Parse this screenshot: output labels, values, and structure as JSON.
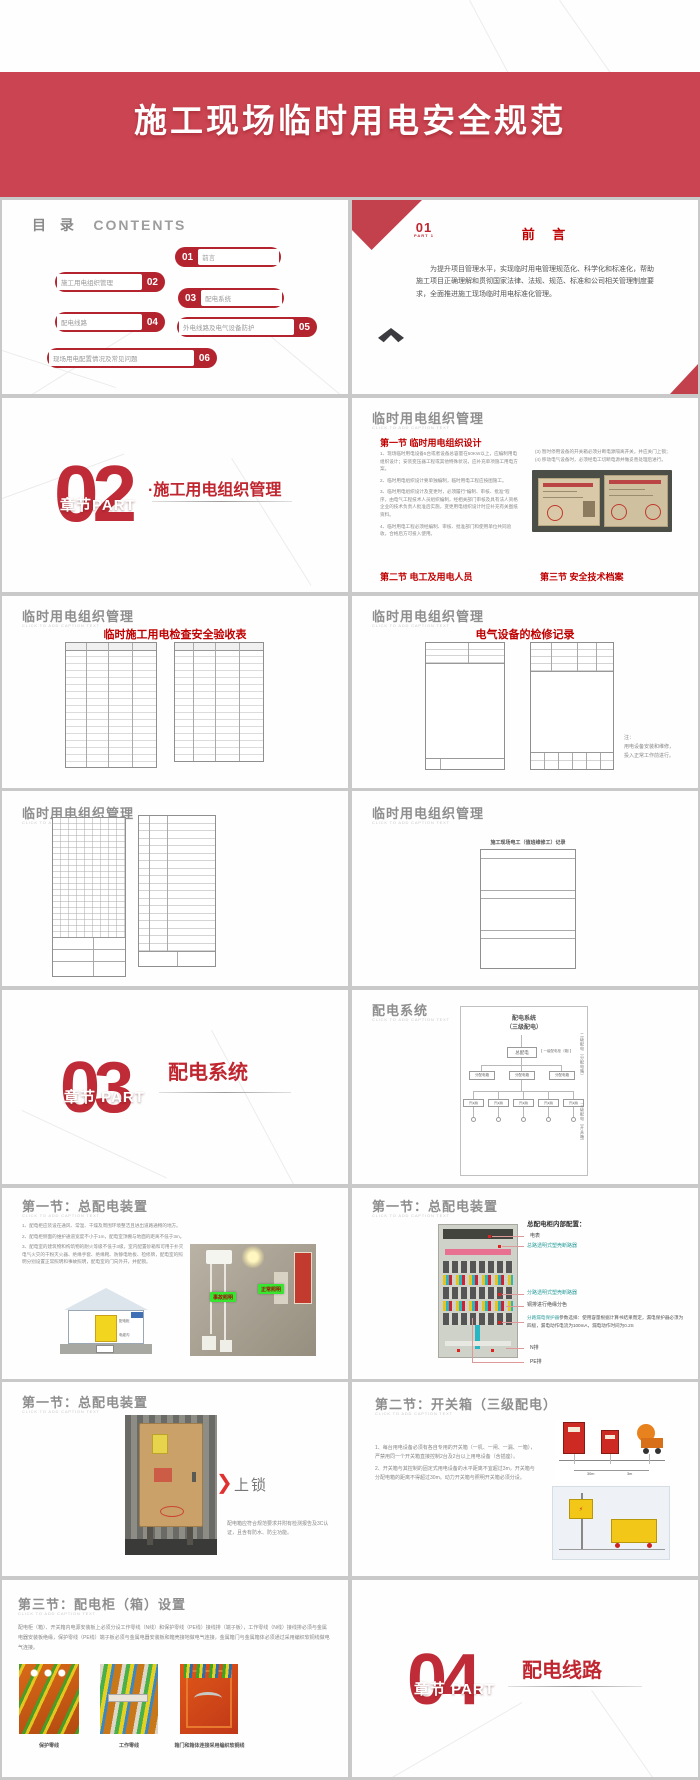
{
  "colors": {
    "banner_red": "#cb4451",
    "pill_red": "#b3242e",
    "number_red": "#bf2b36",
    "heading_red": "#c00000",
    "teal": "#2e9e9e",
    "callout_green": "#35e52f"
  },
  "cover": {
    "title": "施工现场临时用电安全规范"
  },
  "contents": {
    "heading_cn": "目 录",
    "heading_en": "CONTENTS",
    "items": [
      {
        "num": "01",
        "label": "前言"
      },
      {
        "num": "02",
        "label": "施工用电组织管理"
      },
      {
        "num": "03",
        "label": "配电系统"
      },
      {
        "num": "04",
        "label": "配电线路"
      },
      {
        "num": "05",
        "label": "外电线路及电气设备防护"
      },
      {
        "num": "06",
        "label": "现场用电配置情况及常见问题"
      }
    ]
  },
  "preface": {
    "part_num": "01",
    "part_label": "PART 1",
    "title": "前 言",
    "body": "为提升项目管理水平，实现临时用电管理规范化、科学化和标准化，帮助施工项目正确理解和贯彻国家法律、法规、规范、标准和公司相关管理制度要求，全面推进施工现场临时用电标准化管理。"
  },
  "section02": {
    "number": "02",
    "chapter": "章节PART",
    "title": "·施工用电组织管理"
  },
  "org_mgmt": {
    "title": "临时用电组织管理",
    "caption": "CLICK TO ADD CAPTION TEXT",
    "sec1": "第一节 临时用电组织设计",
    "para1": "1、现场临时用电设备5台或者设备总容量在50KW以上，应编制用电组织设计；安装变压器工程或其他特殊状况，应补充单项施工用电方案。",
    "para2": "2、临时用电组织设计要单独编制，临时用电工程应按图施工。",
    "para3": "3、临时用电组织设计及变更时，必须履行“编制、审核、批准”程序，由电气工程技术人员组织编制，经相关部门审核及具有法人资格企业的技术负责人批准后实施，变更用电组织设计时应补充有关图纸资料。",
    "para4": "4、临时用电工程必须经编制、审核、批准部门和使用单位共同验收，合格后方可投入使用。",
    "right_item3": "(3) 暂时停用设备的开关箱必须分断电源隔离开关，并应关门上锁；",
    "right_item4": "(4) 移动电气设备时，必须经电工切断电源并做妥善处理后进行。",
    "sec2": "第二节 电工及用电人员",
    "sec3": "第三节 安全技术档案"
  },
  "checklist": {
    "title": "临时用电组织管理",
    "caption": "CLICK TO ADD CAPTION TEXT",
    "heading": "临时施工用电检查安全验收表"
  },
  "repair": {
    "title": "临时用电组织管理",
    "caption": "CLICK TO ADD CAPTION TEXT",
    "heading": "电气设备的检修记录",
    "note": "注：\n用电设备安装和维修，\n投入正常工作前进行。"
  },
  "records": {
    "title": "临时用电组织管理",
    "caption": "CLICK TO ADD CAPTION TEXT"
  },
  "electrician": {
    "title": "临时用电组织管理",
    "caption": "CLICK TO ADD CAPTION TEXT",
    "form_title": "施工现场电工（值班维修工）记录"
  },
  "section03": {
    "number": "03",
    "chapter": "章节 PART",
    "title": "配电系统"
  },
  "dist_system": {
    "title": "配电系统",
    "caption": "CLICK TO ADD CAPTION TEXT",
    "diagram_title": "配电系统\n（三级配电）",
    "root": "总配电",
    "level1": "【 一级配电柜（箱）】",
    "level2": "二级配电（分配电箱）",
    "level3": "三级配电（开关箱）",
    "box2": "分配电箱",
    "box3": "开关箱"
  },
  "main_dist1": {
    "title": "第一节：总配电装置",
    "caption": "CLICK TO ADD CAPTION TEXT",
    "para1": "1、配电柜应装设在通风、常温、干燥及周围环境整洁且进出道路通畅的地方。",
    "para2": "2、配电柜侧面的维护通道宽度不小于1m，配电室顶棚与地面的距离不低于3m。",
    "para3": "3、配电室的建筑物和构筑物的耐火等级不低于3级，室内配置砂箱和可用于扑灭电气火灾的干粉灭火器、绝缘手套、绝缘靴、防静电地板、检修牌，配电室的照明分别设置正常照明和事故照明，配电室的门向外开，并配锁。",
    "diagram_cabinet": "配电柜",
    "diagram_trench": "电缆沟",
    "callout_accident": "事故照明",
    "callout_normal": "正常照明"
  },
  "main_dist2": {
    "title": "第一节：总配电装置",
    "caption": "CLICK TO ADD CAPTION TEXT",
    "heading": "总配电柜内部配置：",
    "label_meter": "电表",
    "label_main_breaker": "总路透明式塑壳断路器",
    "label_branch_breaker": "分路透明式塑壳断路器",
    "label_busbar": "铜排进行绝缘分色",
    "label_rcd_head": "分路漏电保护器",
    "label_rcd_rest": "参数选择：使用容量根据计算书结果而定，漏电保护器必须为四极，漏电动作电流为100mA，漏电动作时间为0.2S",
    "label_n": "N排",
    "label_pe": "PE排"
  },
  "main_dist3": {
    "title": "第一节：总配电装置",
    "caption": "CLICK TO ADD CAPTION TEXT",
    "arrow_label": "上锁",
    "note": "配电箱应符合规范要求并附有检测报告及3C认证，且含有防水、防尘功能。"
  },
  "switch_box": {
    "title": "第二节：开关箱（三级配电）",
    "caption": "CLICK TO ADD CAPTION TEXT",
    "para1": "1、每台用电设备必须有各自专用的开关箱（一机、一闸、一漏、一箱），严禁用同一个开关箱直接控制2台及2台以上用电设备（含插座）。",
    "para2": "2、开关箱与其控制的固定式用电设备的水平距离不宜超过3m，开关箱与分配电箱的距离不得超过30m。动力开关箱与照明开关箱必须分设。",
    "dim1": "30m",
    "dim2": "3m"
  },
  "cabinet_setup": {
    "title": "第三节：配电柜（箱）设置",
    "caption": "CLICK TO ADD CAPTION TEXT",
    "body": "配电柜（箱）、开关箱内电源安装板上必须分设工作零线（N线）和保护零线（PE线）接线排（端子板），工作零线（N线）接线排必须与金属电器安装板绝缘，保护零线（PE线）端子板必须与金属电器安装板和箱壳接地做电气连接，金属箱门与金属箱体必须通过采用编织软铜线做电气连接。",
    "captions": [
      "保护零线",
      "工作零线",
      "箱门和箱体连接采用编织软铜线"
    ]
  },
  "section04": {
    "number": "04",
    "chapter": "章节 PART",
    "title": "配电线路"
  }
}
